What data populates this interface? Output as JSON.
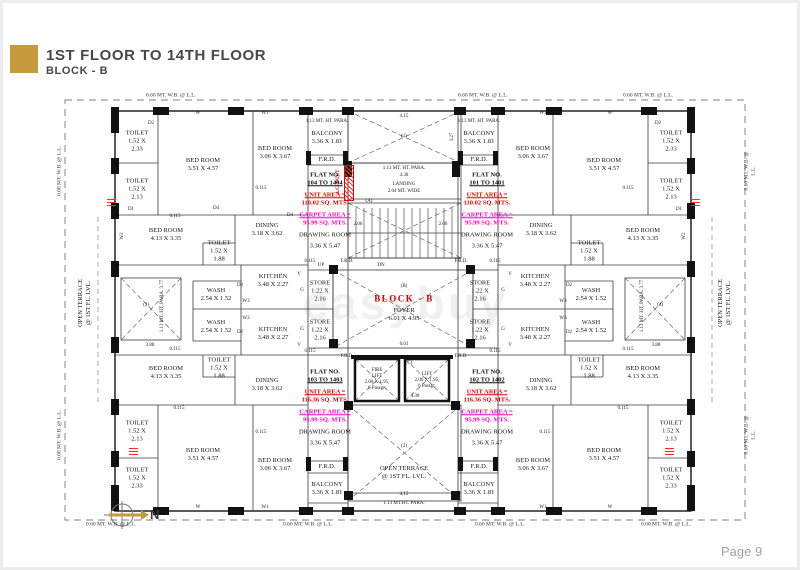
{
  "header": {
    "title": "1ST FLOOR TO 14TH FLOOR",
    "subtitle": "BLOCK - B"
  },
  "footer": {
    "page": "Page 9"
  },
  "compass": {
    "label": "N"
  },
  "watermark": "easybuy",
  "colors": {
    "accent_gold": "#c49b3c",
    "unit_area_red": "#e60000",
    "carpet_magenta": "#ff00cc",
    "block_label_red": "#d40000",
    "wall_black": "#111111",
    "boundary_dash_gray": "#999999"
  },
  "flats": [
    {
      "flat_no": "FLAT NO.",
      "range": "104 TO 1404",
      "unit_label": "UNIT AREA =",
      "unit": "110.02 SQ. MTS.",
      "carpet_label": "CARPET AREA =",
      "carpet": "95.99 SQ. MTS.",
      "room": "DRAWING ROOM",
      "dims": "3.36 X 5.47"
    },
    {
      "flat_no": "FLAT NO.",
      "range": "101 TO 1401",
      "unit_label": "UNIT AREA =",
      "unit": "110.02 SQ. MTS.",
      "carpet_label": "CARPET AREA =",
      "carpet": "95.99 SQ. MTS.",
      "room": "DRAWING ROOM",
      "dims": "3.36 X 5.47"
    },
    {
      "flat_no": "FLAT NO.",
      "range": "103 TO 1403",
      "unit_label": "UNIT AREA =",
      "unit": "116.36 SQ. MTS.",
      "carpet_label": "CARPET AREA =",
      "carpet": "95.99 SQ. MTS.",
      "room": "DRAWING ROOM",
      "dims": "3.36 X 5.47"
    },
    {
      "flat_no": "FLAT NO.",
      "range": "102 TO 1402",
      "unit_label": "UNIT AREA =",
      "unit": "116.36 SQ. MTS.",
      "carpet_label": "CARPET AREA =",
      "carpet": "95.99 SQ. MTS.",
      "room": "DRAWING ROOM",
      "dims": "3.36 X 5.47"
    }
  ],
  "plan": {
    "labels": [
      {
        "t": "0.60 MT. W.B. @ L.L.",
        "x": 168,
        "y": 93,
        "c": "sm"
      },
      {
        "t": "0.60 MT. W.B. @ L.L.",
        "x": 480,
        "y": 93,
        "c": "sm"
      },
      {
        "t": "0.60 MT. W.B. @ L.L.",
        "x": 645,
        "y": 93,
        "c": "sm"
      },
      {
        "t": "0.60 MT. W.B. @ L.L.",
        "x": 108,
        "y": 522,
        "c": "sm"
      },
      {
        "t": "0.60 MT. W.B. @ L.L.",
        "x": 305,
        "y": 522,
        "c": "sm"
      },
      {
        "t": "0.60 MT. W.B. @ L.L.",
        "x": 497,
        "y": 522,
        "c": "sm"
      },
      {
        "t": "0.60 MT. W.B. @ L.L.",
        "x": 663,
        "y": 522,
        "c": "sm"
      },
      {
        "t": "0.60 MT. W.B. @ L.L.",
        "x": 57,
        "y": 168,
        "r": -90,
        "c": "sm"
      },
      {
        "t": "0.60 MT. W.B. @ L.L.",
        "x": 57,
        "y": 432,
        "r": -90,
        "c": "sm"
      },
      {
        "t": "0.60 MT. W.B. @ L.L.",
        "x": 747,
        "y": 168,
        "r": -90,
        "c": "sm"
      },
      {
        "t": "0.60 MT. W.B. @ L.L.",
        "x": 747,
        "y": 432,
        "r": -90,
        "c": "sm"
      },
      {
        "t": "OPEN TERRACE\n@ 1ST FL. LVL.",
        "x": 82,
        "y": 300,
        "r": -90
      },
      {
        "t": "OPEN TERRACE\n@ 1ST FL. LVL.",
        "x": 722,
        "y": 300,
        "r": -90
      },
      {
        "t": "TOILET\n1.52 X\n2.33",
        "x": 134,
        "y": 138
      },
      {
        "t": "TOILET\n1.52 X\n2.13",
        "x": 134,
        "y": 186
      },
      {
        "t": "BED ROOM\n3.51 X 4.57",
        "x": 200,
        "y": 162
      },
      {
        "t": "BED ROOM\n3.06 X 3.67",
        "x": 272,
        "y": 150
      },
      {
        "t": "BED ROOM\n4.13 X 3.35",
        "x": 163,
        "y": 232
      },
      {
        "t": "TOILET\n1.52 X\n1.88",
        "x": 216,
        "y": 248
      },
      {
        "t": "DINING\n3.18 X 3.62",
        "x": 264,
        "y": 227
      },
      {
        "t": "KITCHEN\n3.48 X 2.27",
        "x": 270,
        "y": 278
      },
      {
        "t": "KITCHEN\n3.48 X 2.27",
        "x": 270,
        "y": 331
      },
      {
        "t": "WASH\n2.54 X 1.52",
        "x": 213,
        "y": 292
      },
      {
        "t": "WASH\n2.54 X 1.52",
        "x": 213,
        "y": 324
      },
      {
        "t": "STORE\n1.22 X\n2.16",
        "x": 317,
        "y": 288
      },
      {
        "t": "STORE\n1.22 X\n2.16",
        "x": 317,
        "y": 327
      },
      {
        "t": "BALCONY\n3.36 X 1.81",
        "x": 324,
        "y": 135
      },
      {
        "t": "F.R.D.",
        "x": 324,
        "y": 157
      },
      {
        "t": "1.13 MT. HT. PARA.",
        "x": 324,
        "y": 119,
        "c": "xs"
      },
      {
        "t": "TOILET\n1.52 X\n2.33",
        "x": 668,
        "y": 138
      },
      {
        "t": "TOILET\n1.52 X\n2.13",
        "x": 668,
        "y": 186
      },
      {
        "t": "BED ROOM\n3.51 X 4.57",
        "x": 601,
        "y": 162
      },
      {
        "t": "BED ROOM\n3.06 X 3.67",
        "x": 530,
        "y": 150
      },
      {
        "t": "BED ROOM\n4.13 X 3.35",
        "x": 640,
        "y": 232
      },
      {
        "t": "TOILET\n1.52 X\n1.88",
        "x": 586,
        "y": 248
      },
      {
        "t": "DINING\n3.18 X 3.62",
        "x": 538,
        "y": 227
      },
      {
        "t": "KITCHEN\n3.48 X 2.27",
        "x": 532,
        "y": 278
      },
      {
        "t": "KITCHEN\n3.48 X 2.27",
        "x": 532,
        "y": 331
      },
      {
        "t": "WASH\n2.54 X 1.52",
        "x": 588,
        "y": 292
      },
      {
        "t": "WASH\n2.54 X 1.52",
        "x": 588,
        "y": 324
      },
      {
        "t": "STORE\n1.22 X\n2.16",
        "x": 477,
        "y": 288
      },
      {
        "t": "STORE\n1.22 X\n2.16",
        "x": 477,
        "y": 327
      },
      {
        "t": "BALCONY\n3.36 X 1.81",
        "x": 476,
        "y": 135
      },
      {
        "t": "F.R.D.",
        "x": 476,
        "y": 157
      },
      {
        "t": "1.13 MT. HT. PARA.",
        "x": 476,
        "y": 119,
        "c": "xs"
      },
      {
        "t": "BED ROOM\n4.13 X 3.35",
        "x": 163,
        "y": 370
      },
      {
        "t": "TOILET\n1.52 X\n1.88",
        "x": 216,
        "y": 365
      },
      {
        "t": "DINING\n3.18 X 3.62",
        "x": 264,
        "y": 382
      },
      {
        "t": "TOILET\n1.52 X\n2.13",
        "x": 134,
        "y": 428
      },
      {
        "t": "TOILET\n1.52 X\n2.33",
        "x": 134,
        "y": 475
      },
      {
        "t": "BED ROOM\n3.51 X 4.57",
        "x": 200,
        "y": 452
      },
      {
        "t": "BED ROOM\n3.06 X 3.67",
        "x": 272,
        "y": 462
      },
      {
        "t": "BALCONY\n3.36 X 1.81",
        "x": 324,
        "y": 486
      },
      {
        "t": "F.R.D.",
        "x": 324,
        "y": 464
      },
      {
        "t": "BED ROOM\n4.13 X 3.35",
        "x": 640,
        "y": 370
      },
      {
        "t": "TOILET\n1.52 X\n1.88",
        "x": 586,
        "y": 365
      },
      {
        "t": "DINING\n3.18 X 3.62",
        "x": 538,
        "y": 382
      },
      {
        "t": "TOILET\n1.52 X\n2.13",
        "x": 668,
        "y": 428
      },
      {
        "t": "TOILET\n1.52 X\n2.33",
        "x": 668,
        "y": 475
      },
      {
        "t": "BED ROOM\n3.51 X 4.57",
        "x": 601,
        "y": 452
      },
      {
        "t": "BED ROOM\n3.06 X 3.67",
        "x": 530,
        "y": 462
      },
      {
        "t": "BALCONY\n3.36 X 1.81",
        "x": 476,
        "y": 486
      },
      {
        "t": "F.R.D.",
        "x": 476,
        "y": 464
      },
      {
        "t": "4.15",
        "x": 401,
        "y": 114,
        "c": "xs"
      },
      {
        "t": "(1)",
        "x": 401,
        "y": 134,
        "c": "xs"
      },
      {
        "t": "3.27",
        "x": 450,
        "y": 134,
        "r": -90,
        "c": "xs"
      },
      {
        "t": "1.13 MT. HT. PARA.",
        "x": 401,
        "y": 166,
        "c": "xs"
      },
      {
        "t": "4.38",
        "x": 401,
        "y": 173,
        "c": "xs"
      },
      {
        "t": "LANDING",
        "x": 401,
        "y": 182,
        "c": "xs"
      },
      {
        "t": "2.04 MT. WIDE",
        "x": 401,
        "y": 189,
        "c": "xs"
      },
      {
        "t": "(A)",
        "x": 366,
        "y": 199,
        "c": "xs"
      },
      {
        "t": "2.06",
        "x": 355,
        "y": 222,
        "c": "xs"
      },
      {
        "t": "2.06",
        "x": 440,
        "y": 222,
        "c": "xs"
      },
      {
        "t": "UP",
        "x": 318,
        "y": 263,
        "c": "xs"
      },
      {
        "t": "F.R.D.",
        "x": 344,
        "y": 259,
        "c": "xs"
      },
      {
        "t": "DN",
        "x": 378,
        "y": 263,
        "c": "xs"
      },
      {
        "t": "F.R.D.",
        "x": 458,
        "y": 259,
        "c": "xs"
      },
      {
        "t": "(B)",
        "x": 401,
        "y": 284,
        "c": "xs"
      },
      {
        "t": "BLOCK - B",
        "x": 401,
        "y": 296,
        "c": "bb"
      },
      {
        "t": "FOYER",
        "x": 401,
        "y": 308
      },
      {
        "t": "6.01 X 4.95",
        "x": 401,
        "y": 316
      },
      {
        "t": "6.01",
        "x": 401,
        "y": 342,
        "c": "xs"
      },
      {
        "t": "F.R.D.",
        "x": 344,
        "y": 354,
        "c": "xs"
      },
      {
        "t": "F.R.D.",
        "x": 458,
        "y": 354,
        "c": "xs"
      },
      {
        "t": "0.115",
        "x": 307,
        "y": 259,
        "c": "xs"
      },
      {
        "t": "0.115",
        "x": 492,
        "y": 259,
        "c": "xs"
      },
      {
        "t": "0.115",
        "x": 307,
        "y": 349,
        "c": "xs"
      },
      {
        "t": "0.115",
        "x": 492,
        "y": 349,
        "c": "xs"
      },
      {
        "t": "G",
        "x": 299,
        "y": 288,
        "c": "xs"
      },
      {
        "t": "G",
        "x": 299,
        "y": 327,
        "c": "xs"
      },
      {
        "t": "G",
        "x": 500,
        "y": 288,
        "c": "xs"
      },
      {
        "t": "G",
        "x": 500,
        "y": 327,
        "c": "xs"
      },
      {
        "t": "FIRE\nLIFT\n2.00 X 1.95,\n6 Passgr.",
        "x": 374,
        "y": 377,
        "c": "xs"
      },
      {
        "t": "(C)",
        "x": 406,
        "y": 361,
        "c": "xs"
      },
      {
        "t": "LIFT\n2.00 X 1.95,\n6 Passgr.",
        "x": 424,
        "y": 378,
        "c": "xs"
      },
      {
        "t": "4.30",
        "x": 412,
        "y": 394,
        "c": "xs"
      },
      {
        "t": "(2)",
        "x": 401,
        "y": 444,
        "c": "xs"
      },
      {
        "t": "OPEN TERRACE\n@ 1ST FL. LVL.",
        "x": 401,
        "y": 470
      },
      {
        "t": "4.15",
        "x": 401,
        "y": 492,
        "c": "xs"
      },
      {
        "t": "1.13 MT.HT. PARA.",
        "x": 401,
        "y": 501,
        "c": "xs"
      },
      {
        "t": "(3)",
        "x": 143,
        "y": 303,
        "c": "xs"
      },
      {
        "t": "1.13 MT. HT. PARA.  3.77",
        "x": 160,
        "y": 303,
        "r": -90,
        "c": "xs"
      },
      {
        "t": "3.88",
        "x": 147,
        "y": 343,
        "c": "xs"
      },
      {
        "t": "(4)",
        "x": 657,
        "y": 303,
        "c": "xs"
      },
      {
        "t": "1.13 MT. HT. PARA.  3.77",
        "x": 640,
        "y": 303,
        "r": -90,
        "c": "xs"
      },
      {
        "t": "3.88",
        "x": 653,
        "y": 343,
        "c": "xs"
      },
      {
        "t": "0.115",
        "x": 172,
        "y": 214,
        "c": "xs"
      },
      {
        "t": "0.115",
        "x": 258,
        "y": 186,
        "c": "xs"
      },
      {
        "t": "0.115",
        "x": 625,
        "y": 186,
        "c": "xs"
      },
      {
        "t": "0.115",
        "x": 172,
        "y": 347,
        "c": "xs"
      },
      {
        "t": "0.115",
        "x": 625,
        "y": 347,
        "c": "xs"
      },
      {
        "t": "0.115",
        "x": 176,
        "y": 406,
        "c": "xs"
      },
      {
        "t": "0.115",
        "x": 258,
        "y": 430,
        "c": "xs"
      },
      {
        "t": "0.115",
        "x": 542,
        "y": 430,
        "c": "xs"
      },
      {
        "t": "0.115",
        "x": 620,
        "y": 406,
        "c": "xs"
      },
      {
        "t": "W",
        "x": 195,
        "y": 111,
        "c": "xs"
      },
      {
        "t": "W1",
        "x": 262,
        "y": 111,
        "c": "xs"
      },
      {
        "t": "W1",
        "x": 540,
        "y": 111,
        "c": "xs"
      },
      {
        "t": "W",
        "x": 607,
        "y": 111,
        "c": "xs"
      },
      {
        "t": "W",
        "x": 195,
        "y": 505,
        "c": "xs"
      },
      {
        "t": "W1",
        "x": 262,
        "y": 505,
        "c": "xs"
      },
      {
        "t": "W1",
        "x": 540,
        "y": 505,
        "c": "xs"
      },
      {
        "t": "W",
        "x": 607,
        "y": 505,
        "c": "xs"
      },
      {
        "t": "D2",
        "x": 148,
        "y": 121,
        "c": "xs"
      },
      {
        "t": "D1",
        "x": 128,
        "y": 207,
        "c": "xs"
      },
      {
        "t": "D4",
        "x": 213,
        "y": 206,
        "c": "xs"
      },
      {
        "t": "D4",
        "x": 287,
        "y": 213,
        "c": "xs"
      },
      {
        "t": "W2",
        "x": 120,
        "y": 233,
        "r": -90,
        "c": "xs"
      },
      {
        "t": "W2",
        "x": 682,
        "y": 233,
        "r": -90,
        "c": "xs"
      },
      {
        "t": "D2",
        "x": 237,
        "y": 283,
        "c": "xs"
      },
      {
        "t": "D2",
        "x": 237,
        "y": 330,
        "c": "xs"
      },
      {
        "t": "W3",
        "x": 243,
        "y": 299,
        "c": "xs"
      },
      {
        "t": "W3",
        "x": 243,
        "y": 316,
        "c": "xs"
      },
      {
        "t": "V",
        "x": 296,
        "y": 272,
        "c": "xs"
      },
      {
        "t": "V",
        "x": 296,
        "y": 343,
        "c": "xs"
      },
      {
        "t": "D2",
        "x": 566,
        "y": 283,
        "c": "xs"
      },
      {
        "t": "D2",
        "x": 566,
        "y": 330,
        "c": "xs"
      },
      {
        "t": "W3",
        "x": 560,
        "y": 299,
        "c": "xs"
      },
      {
        "t": "W3",
        "x": 560,
        "y": 316,
        "c": "xs"
      },
      {
        "t": "V",
        "x": 507,
        "y": 272,
        "c": "xs"
      },
      {
        "t": "V",
        "x": 507,
        "y": 343,
        "c": "xs"
      },
      {
        "t": "D1",
        "x": 676,
        "y": 207,
        "c": "xs"
      },
      {
        "t": "D2",
        "x": 655,
        "y": 121,
        "c": "xs"
      },
      {
        "t": "A.C. DUCT",
        "x": 336,
        "y": 179,
        "r": -90,
        "c": "xs redtxt"
      }
    ]
  }
}
